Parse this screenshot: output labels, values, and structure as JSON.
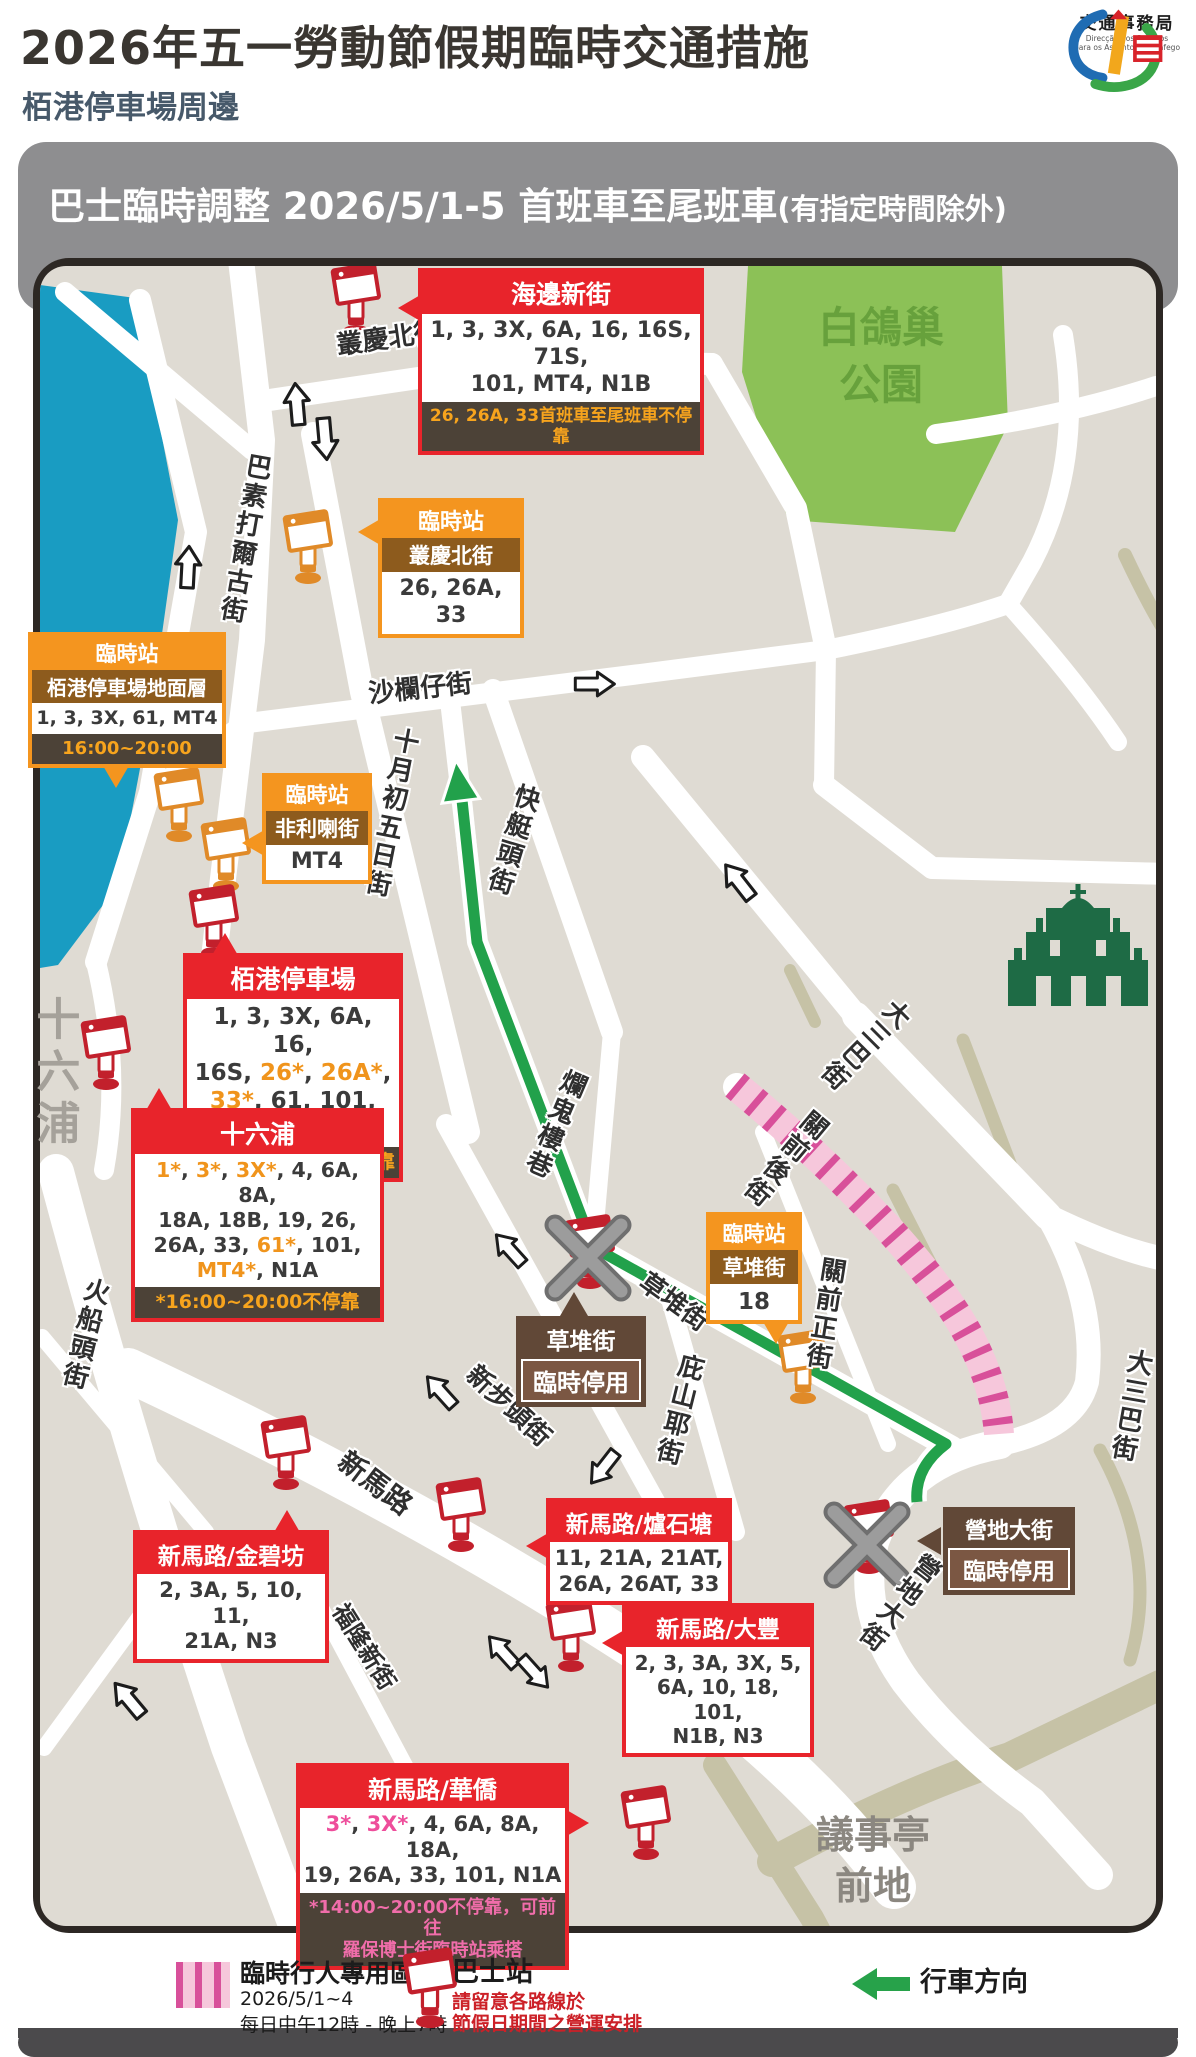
{
  "header": {
    "title": "2026年五一勞動節假期臨時交通措施",
    "subtitle": "栢港停車場周邊",
    "agency": {
      "name": "交通事務局",
      "pt1": "Direcção dos Serviços",
      "pt2": "para os Assuntos de Tráfego"
    }
  },
  "banner": {
    "main": "巴士臨時調整 2026/5/1-5 首班車至尾班車",
    "note": "(有指定時間除外)"
  },
  "map": {
    "area_labels": [
      {
        "id": "park",
        "text": "白鴿巢\n公園"
      },
      {
        "id": "shiliupu-area",
        "text": "十六浦"
      },
      {
        "id": "senado",
        "text": "議事亭\n前地"
      }
    ],
    "street_labels": [
      {
        "text": "叢慶北街"
      },
      {
        "text": "巴素打爾古街"
      },
      {
        "text": "沙欄仔街"
      },
      {
        "text": "十月初五日街"
      },
      {
        "text": "快艇頭街"
      },
      {
        "text": "爛鬼樓巷"
      },
      {
        "text": "草堆街"
      },
      {
        "text": "庇山耶街"
      },
      {
        "text": "關前後街"
      },
      {
        "text": "關前正街"
      },
      {
        "text": "大三巴街"
      },
      {
        "text": "大三巴街"
      },
      {
        "text": "營地大街"
      },
      {
        "text": "新步頭街"
      },
      {
        "text": "新馬路"
      },
      {
        "text": "福隆新街"
      },
      {
        "text": "火船頭街"
      }
    ],
    "boxes": {
      "haibian": {
        "title": "海邊新街",
        "routes": "1, 3, 3X, 6A, 16, 16S, 71S,\n101, MT4, N1B",
        "note": "26, 26A, 33首班車至尾班車不停靠"
      },
      "congqing": {
        "tag": "臨時站",
        "title": "叢慶北街",
        "routes": "26, 26A, 33"
      },
      "dimianceng": {
        "tag": "臨時站",
        "title": "栢港停車場地面層",
        "routes": "1, 3, 3X, 61, MT4",
        "note": "16:00~20:00"
      },
      "feilila": {
        "tag": "臨時站",
        "title": "非利喇街",
        "routes": "MT4"
      },
      "bokong": {
        "title": "栢港停車場",
        "note": "*12:00~17:00不停靠",
        "segments": [
          {
            "t": "1, 3, 3X, 6A, 16,\n16S, ",
            "c": "d"
          },
          {
            "t": "26*",
            "c": "o"
          },
          {
            "t": ", ",
            "c": "d"
          },
          {
            "t": "26A*",
            "c": "o"
          },
          {
            "t": ",\n",
            "c": "d"
          },
          {
            "t": "33*",
            "c": "o"
          },
          {
            "t": ", 61, 101, N1B",
            "c": "d"
          }
        ]
      },
      "shiliupu": {
        "title": "十六浦",
        "note": "*16:00~20:00不停靠",
        "segments": [
          {
            "t": "1*",
            "c": "o"
          },
          {
            "t": ", ",
            "c": "d"
          },
          {
            "t": "3*",
            "c": "o"
          },
          {
            "t": ", ",
            "c": "d"
          },
          {
            "t": "3X*",
            "c": "o"
          },
          {
            "t": ", 4, 6A, 8A,\n18A, 18B, 19, 26,\n26A, 33, ",
            "c": "d"
          },
          {
            "t": "61*",
            "c": "o"
          },
          {
            "t": ", 101,\n",
            "c": "d"
          },
          {
            "t": "MT4*",
            "c": "o"
          },
          {
            "t": ", N1A",
            "c": "d"
          }
        ]
      },
      "caodui_closed": {
        "title": "草堆街",
        "status": "臨時停用"
      },
      "caodui_temp": {
        "tag": "臨時站",
        "title": "草堆街",
        "routes": "18"
      },
      "yingdi_closed": {
        "title": "營地大街",
        "status": "臨時停用"
      },
      "jinbifang": {
        "title": "新馬路/金碧坊",
        "routes": "2, 3A, 5, 10, 11,\n21A, N3"
      },
      "lushitang": {
        "title": "新馬路/爐石塘",
        "routes": "11, 21A, 21AT,\n26A, 26AT, 33"
      },
      "dafeng": {
        "title": "新馬路/大豐",
        "routes": "2, 3, 3A, 3X, 5,\n6A, 10, 18, 101,\nN1B, N3"
      },
      "huaqiao": {
        "title": "新馬路/華僑",
        "note": "*14:00~20:00不停靠，可前往\n羅保博士街臨時站乘搭",
        "segments": [
          {
            "t": "3*",
            "c": "p"
          },
          {
            "t": ", ",
            "c": "d"
          },
          {
            "t": "3X*",
            "c": "p"
          },
          {
            "t": ", 4, 6A, 8A, 18A,\n19, 26A, 33, 101, N1A",
            "c": "d"
          }
        ]
      }
    }
  },
  "legend": {
    "pedestrian": {
      "label": "臨時行人專用區",
      "line1": "2026/5/1~4",
      "line2": "每日中午12時 - 晚上7時"
    },
    "bus_stop": {
      "label": "巴士站",
      "note1": "請留意各路線於",
      "note2": "節假日期間之營運安排"
    },
    "direction": {
      "label": "行車方向"
    }
  },
  "colors": {
    "accent_red": "#e8242b",
    "accent_orange": "#f4951f",
    "brown": "#614837",
    "water": "#199cc2",
    "park": "#8cc157",
    "route_green": "#22a14b",
    "pink_zone": "#f6c7db",
    "pink_stripe": "#d8509a"
  }
}
